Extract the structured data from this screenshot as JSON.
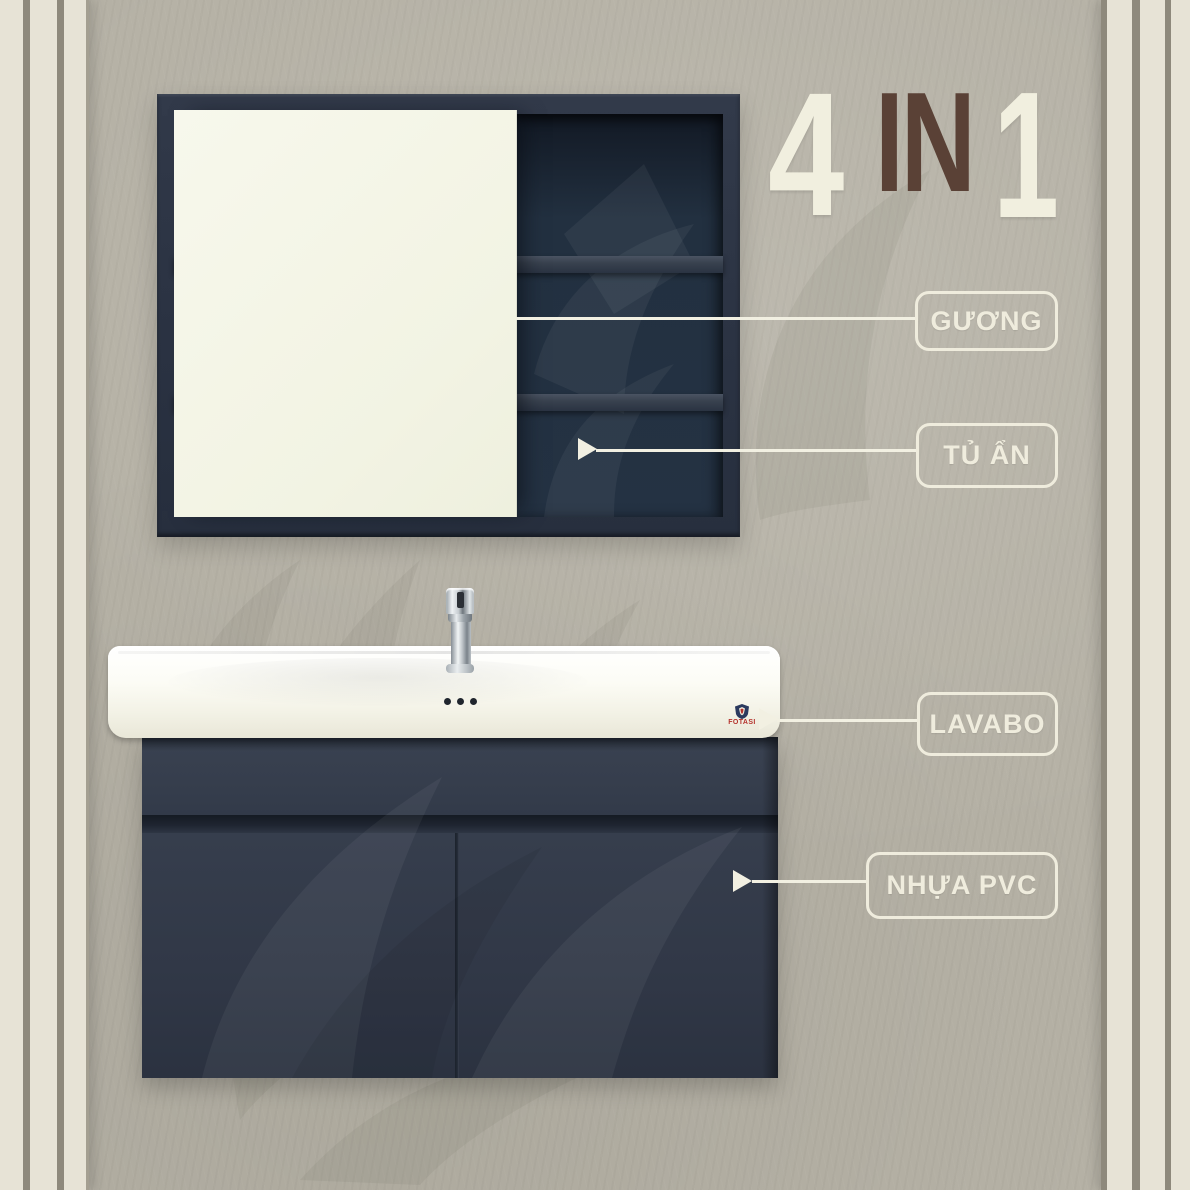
{
  "badge": {
    "count": "4",
    "connector": "IN",
    "result": "1"
  },
  "callouts": [
    {
      "id": "guong",
      "label": "GƯƠNG"
    },
    {
      "id": "tu-an",
      "label": "TỦ ẨN"
    },
    {
      "id": "lavabo",
      "label": "LAVABO"
    },
    {
      "id": "nhua-pvc",
      "label": "NHỰA PVC"
    }
  ],
  "brand": {
    "name": "FOTASI"
  },
  "icons": {
    "callout_arrow": "right-pointing-triangle",
    "brand_shield": "shield"
  },
  "colors": {
    "background": "#b5b1a5",
    "trim_cream": "#e7e3d6",
    "trim_stripe": "#8e897c",
    "cabinet_navy": "#2b3343",
    "mirror_cream": "#f4f5e7",
    "accent_cream": "#efecdd",
    "accent_brown": "#5a4136",
    "brand_red": "#b4322c"
  }
}
